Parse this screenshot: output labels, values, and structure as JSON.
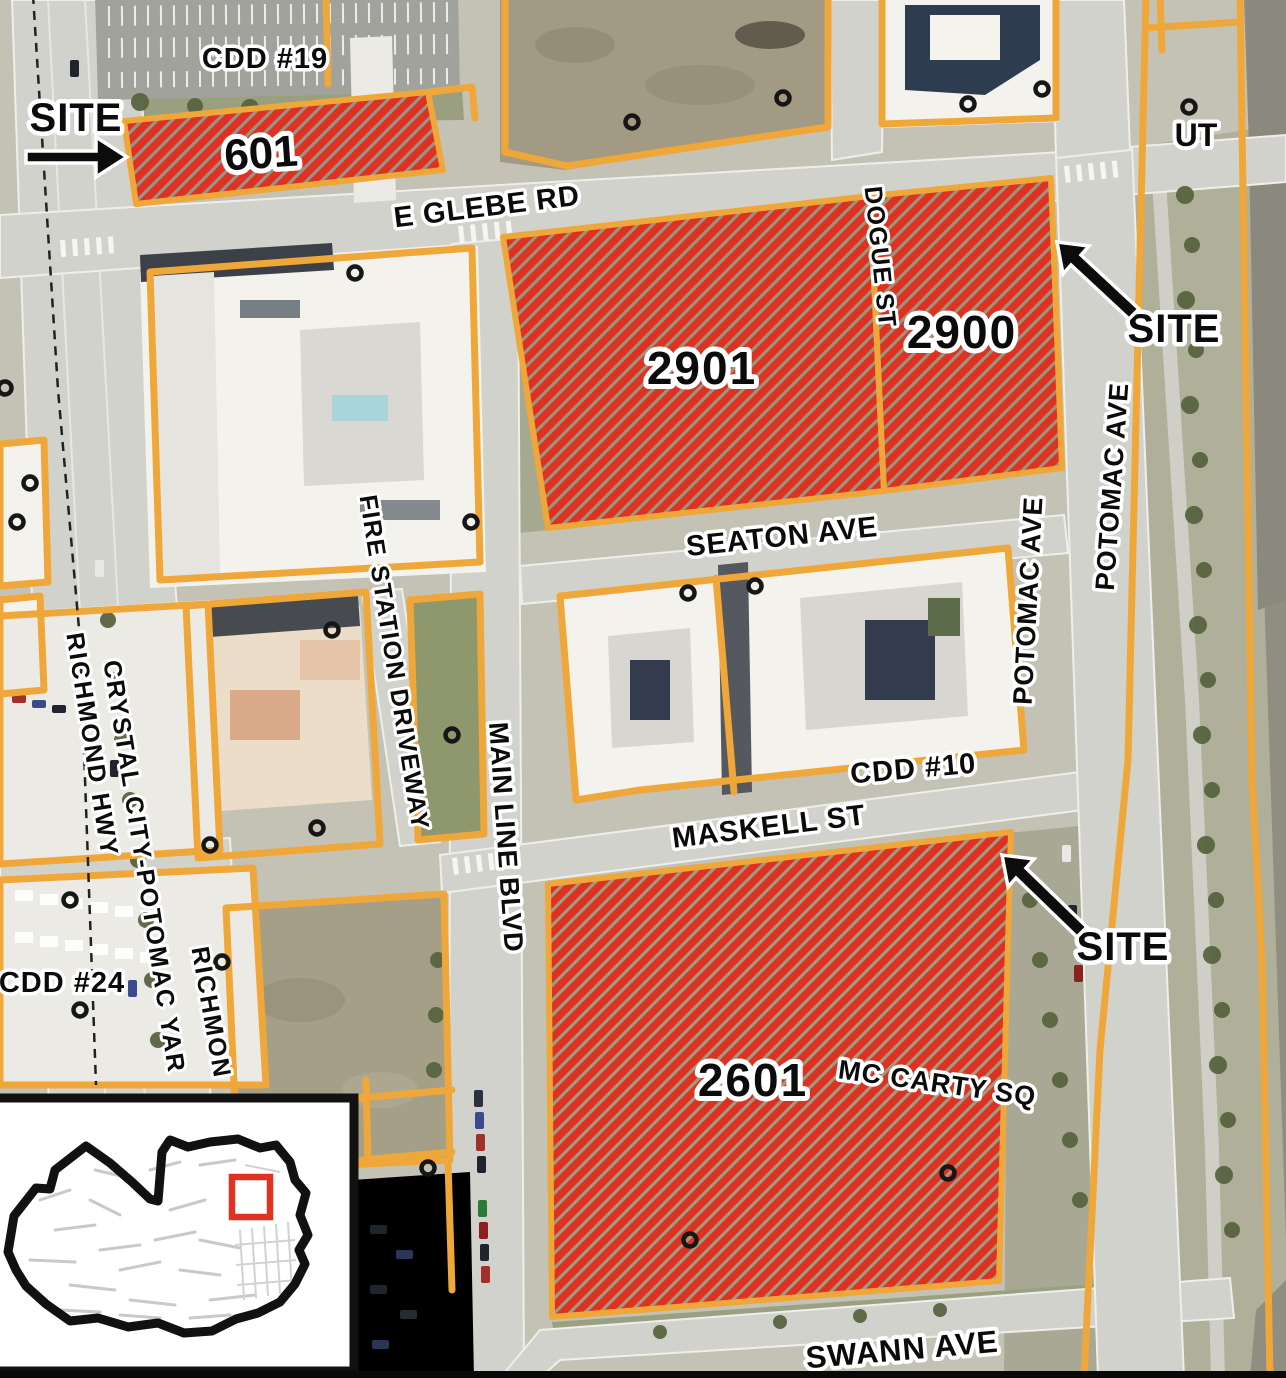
{
  "map": {
    "parcels": [
      {
        "number": "601"
      },
      {
        "number": "2901"
      },
      {
        "number": "2900"
      },
      {
        "number": "2601"
      }
    ],
    "site_callouts": [
      "SITE",
      "SITE",
      "SITE"
    ],
    "district_labels": {
      "cdd_19": "CDD #19",
      "cdd_10": "CDD #10",
      "cdd_24": "CDD #24"
    },
    "street_labels": {
      "e_glebe_rd": "E GLEBE RD",
      "dogue_st": "DOGUE ST",
      "seaton_ave": "SEATON AVE",
      "potomac_ave_west": "POTOMAC AVE",
      "potomac_ave_east": "POTOMAC AVE",
      "maskell_st": "MASKELL ST",
      "fire_station_driveway": "FIRE STATION DRIVEWAY",
      "main_line_blvd": "MAIN LINE BLVD",
      "crystal_city_potomac_yard": "CRYSTAL CITY-POTOMAC YAR",
      "richmond_hwy": "RICHMOND HWY",
      "richmond_partial": "RICHMON",
      "mc_carty_sq": "MC CARTY SQ",
      "swann_ave": "SWANN AVE",
      "ut": "UT"
    },
    "colors": {
      "site_hatch_red": "#df3120",
      "parcel_outline_orange": "#f0a73a",
      "road_gray": "#d2d2cd",
      "inset_locator_red": "#e03222"
    }
  }
}
